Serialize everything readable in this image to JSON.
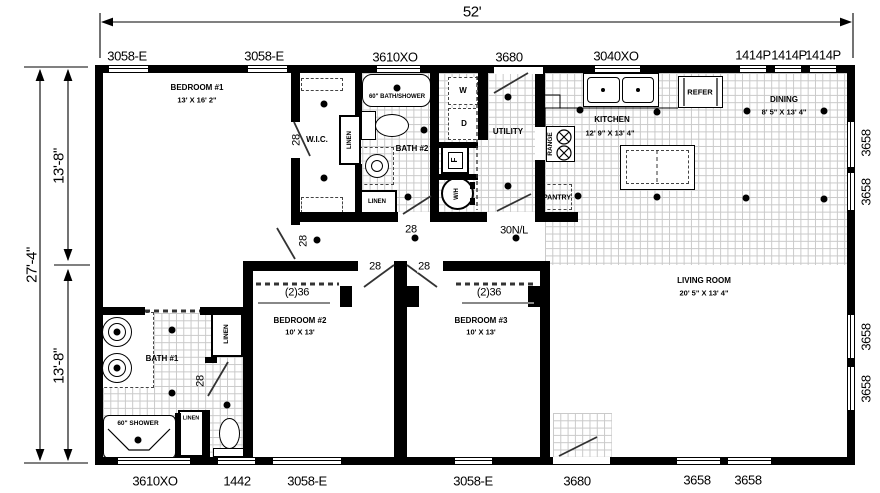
{
  "perimeter": {
    "top_dim": "52'",
    "left_dims": {
      "overall": "27'-4\"",
      "upper": "13'-8\"",
      "lower": "13'-8\""
    },
    "top_labels": [
      "3058-E",
      "3058-E",
      "3610XO",
      "3680",
      "3040XO",
      "1414P",
      "1414P",
      "1414P"
    ],
    "bottom_labels": [
      "3610XO",
      "1442",
      "3058-E",
      "3058-E",
      "3680",
      "3658",
      "3658"
    ],
    "right_labels": [
      "3658",
      "3658",
      "3658",
      "3658"
    ]
  },
  "rooms": {
    "bedroom1": {
      "name": "BEDROOM #1",
      "dims": "13' X 16' 2\""
    },
    "bedroom2": {
      "name": "BEDROOM #2",
      "dims": "10' X 13'"
    },
    "bedroom3": {
      "name": "BEDROOM #3",
      "dims": "10' X 13'"
    },
    "living": {
      "name": "LIVING ROOM",
      "dims": "20' 5\" X 13' 4\""
    },
    "kitchen": {
      "name": "KITCHEN",
      "dims": "12' 9\" X 13' 4\""
    },
    "dining": {
      "name": "DINING",
      "dims": "8' 5\" X 13' 4\""
    },
    "bath1": {
      "name": "BATH #1"
    },
    "bath2": {
      "name": "BATH #2"
    },
    "utility": {
      "name": "UTILITY"
    },
    "wic": {
      "name": "W.I.C."
    },
    "pantry": {
      "name": "PANTRY"
    }
  },
  "fixtures": {
    "tub": "60\" BATH/SHOWER",
    "shower": "60\" SHOWER",
    "refer": "REFER",
    "range": "RANGE",
    "washer": "W",
    "dryer": "D",
    "furnace": "F",
    "water_heater": "W/H",
    "linen_wic": "LINEN",
    "linen_bath2": "LINEN",
    "linen_bath1_upper": "LINEN",
    "linen_bath1_lower": "LINEN"
  },
  "doors": {
    "bedroom1": "28",
    "wic": "28",
    "bath2": "28",
    "utility_interior": "30N/L",
    "bedroom2": "28",
    "bedroom3": "28",
    "bath1_toilet": "28",
    "closet2": "(2)36",
    "closet3": "(2)36"
  },
  "colors": {
    "wall": "#000000",
    "tile_grid": "#c9c9c9",
    "background": "#ffffff"
  }
}
